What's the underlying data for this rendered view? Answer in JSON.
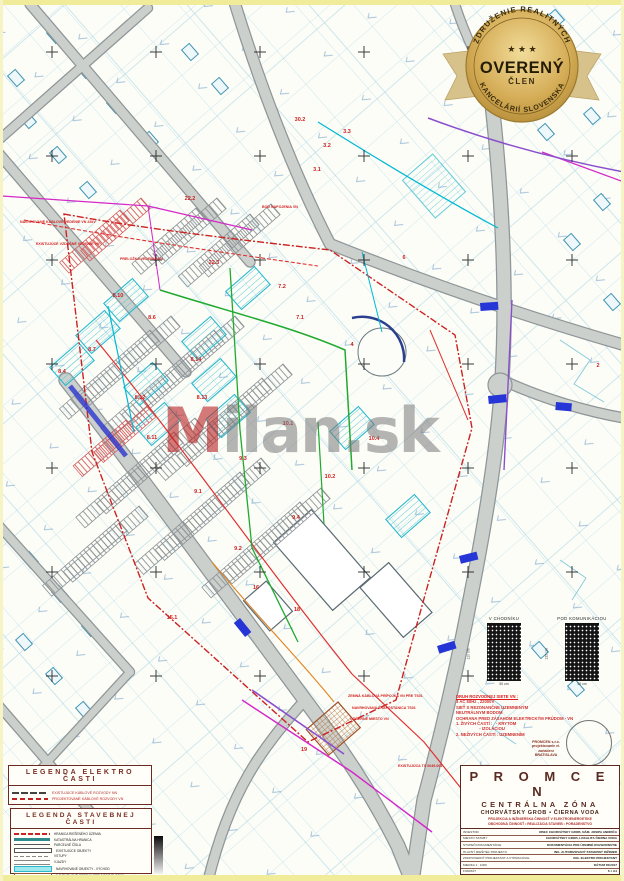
{
  "badge": {
    "arc_top": "ZDRUŽENIE REALITNÝCH",
    "arc_bottom": "KANCELÁRIÍ SLOVENSKA",
    "stars": "★ ★ ★",
    "main": "OVERENÝ",
    "sub": "ČLEN",
    "gold": "#d4ac56",
    "text_color": "#3a2c0c"
  },
  "watermark": {
    "first": "M",
    "rest": "ilan.sk"
  },
  "map": {
    "parcel_labels": [
      {
        "t": "30.2",
        "x": 300,
        "y": 120
      },
      {
        "t": "3.3",
        "x": 347,
        "y": 132
      },
      {
        "t": "3.2",
        "x": 327,
        "y": 146
      },
      {
        "t": "3.1",
        "x": 317,
        "y": 170
      },
      {
        "t": "22.2",
        "x": 190,
        "y": 199
      },
      {
        "t": "22.3",
        "x": 214,
        "y": 263
      },
      {
        "t": "7.2",
        "x": 282,
        "y": 287
      },
      {
        "t": "7.1",
        "x": 300,
        "y": 318
      },
      {
        "t": "8.10",
        "x": 118,
        "y": 296
      },
      {
        "t": "8.6",
        "x": 152,
        "y": 318
      },
      {
        "t": "8.7",
        "x": 92,
        "y": 350
      },
      {
        "t": "8.4",
        "x": 62,
        "y": 372
      },
      {
        "t": "8.14",
        "x": 196,
        "y": 360
      },
      {
        "t": "8.13",
        "x": 202,
        "y": 398
      },
      {
        "t": "8.12",
        "x": 140,
        "y": 398
      },
      {
        "t": "8.11",
        "x": 152,
        "y": 438
      },
      {
        "t": "10.1",
        "x": 288,
        "y": 424
      },
      {
        "t": "10.4",
        "x": 374,
        "y": 439
      },
      {
        "t": "10.2",
        "x": 330,
        "y": 477
      },
      {
        "t": "9.3",
        "x": 243,
        "y": 459
      },
      {
        "t": "9.1",
        "x": 198,
        "y": 492
      },
      {
        "t": "9.4",
        "x": 296,
        "y": 518
      },
      {
        "t": "9.2",
        "x": 238,
        "y": 549
      },
      {
        "t": "16",
        "x": 256,
        "y": 588
      },
      {
        "t": "18",
        "x": 297,
        "y": 610
      },
      {
        "t": "15.1",
        "x": 172,
        "y": 618
      },
      {
        "t": "19",
        "x": 304,
        "y": 750
      },
      {
        "t": "2",
        "x": 598,
        "y": 366
      },
      {
        "t": "4",
        "x": 352,
        "y": 345
      },
      {
        "t": "6",
        "x": 404,
        "y": 258
      }
    ],
    "callouts": [
      {
        "t": "NAVRHOVANÉ KÁBLOVÉ VEDENIE VN 22kV",
        "x": 20,
        "y": 220
      },
      {
        "t": "EXISTUJÚCE VZDUŠNÉ VEDENIE VN",
        "x": 36,
        "y": 242
      },
      {
        "t": "PRELOŽKA VEDENIA NN",
        "x": 120,
        "y": 257
      },
      {
        "t": "BOD NAPOJENIA VN",
        "x": 262,
        "y": 205
      },
      {
        "t": "ZEMNÁ KÁBLOVÁ PRÍPOJKA VN PRE TS01",
        "x": 348,
        "y": 694
      },
      {
        "t": "NAVRHOVANÁ TRAFOSTANICA TS01",
        "x": 352,
        "y": 706
      },
      {
        "t": "ODBERNÉ MIESTO VN",
        "x": 350,
        "y": 717
      },
      {
        "t": "EXISTUJÚCA TS 0049-001",
        "x": 398,
        "y": 764
      }
    ]
  },
  "details": {
    "left": {
      "label": "V CHODNÍKU",
      "h": "110 cm",
      "w": "50 cm"
    },
    "right": {
      "label": "POD KOMUNIKÁCIOU",
      "h": "125 cm",
      "w": "50 cm"
    }
  },
  "specs": {
    "lines": [
      "DRUH ROZVODNEJ SIETE VN :",
      "3 AC 50Hz , 22000V",
      "SIEŤ S REZONANČNE UZEMNENÝM",
      "NEUTRÁLNYM BODOM",
      "OCHRANA PRED ZÁSAHOM ELEKTRICKÝM PRÚDOM - VN",
      "1. ŽIVÝCH ČASTÍ :   - KRYTOM",
      "                    - IZOLÁCIOU",
      "2. NEŽIVÝCH ČASTÍ : UZEMNENÍM"
    ]
  },
  "stamp": {
    "logo_lines": [
      "PROMCEN s.r.o.",
      "projektovanie el. zariadení",
      "BRATISLAVA"
    ]
  },
  "legends": {
    "elektro": {
      "title": "LEGENDA ELEKTRO ČASTI",
      "rows": [
        {
          "swatch": "sw-exist-nn",
          "label": "EXISTUJÚCE KÁBLOVÉ ROZVODY NN",
          "color": "#b03030"
        },
        {
          "swatch": "sw-proj-nn",
          "label": "PROJEKTOVANÉ KÁBLOVÉ ROZVODY VN",
          "color": "#c02020"
        }
      ]
    },
    "stavebna": {
      "title": "LEGENDA STAVEBNEJ ČASTI",
      "rows": [
        {
          "swatch": "sw-boundary",
          "label": "HRANICA RIEŠENÉHO ÚZEMIA"
        },
        {
          "swatch": "sw-kataster",
          "label": "KATASTRÁLNA HRANICA"
        },
        {
          "swatch": "sw-parcel",
          "label": "PARCELNÉ ČÍSLA"
        },
        {
          "swatch": "sw-exist",
          "label": "EXISTUJÚCE OBJEKTY"
        },
        {
          "swatch": "sw-vstupy",
          "label": "VSTUPY"
        },
        {
          "swatch": "sw-vjazdy",
          "label": "VJAZDY"
        },
        {
          "swatch": "sw-navrh-obj",
          "label": "NAVRHOVANÉ OBJEKTY - VÝCHOD"
        },
        {
          "swatch": "sw-cesty",
          "label": "NAVRHOVANÉ CESTY A SPEVNENÉ PLOCHY"
        },
        {
          "swatch": "sw-park",
          "label": "NAVRHOVANÉ ODSTAVNÉ A PARKOVACIE PLOCHY"
        }
      ]
    }
  },
  "title_block": {
    "company": "P R O M C E N",
    "zone": "CENTRÁLNA ZÓNA",
    "place": "CHORVÁTSKY GROB • ČIERNA VODA",
    "red1": "PROJEKCIA A INŽINIERSKA ČINNOSŤ V ELEKTROENERGETIKE",
    "red2": "OBCHODNÁ ČINNOSŤ • REALIZÁCIA STAVIEB • PORADENSTVO",
    "rows": [
      {
        "l": "INVESTOR",
        "r": "OBEC CHORVÁTSKY GROB, NÁM. JOSIPA ANDRIČA"
      },
      {
        "l": "MIESTO STAVBY",
        "r": "CHORVÁTSKY GROB, LOKALITA ČIERNA VODA"
      },
      {
        "l": "STUPEŇ DOKUMENTÁCIE",
        "r": "DOKUMENTÁCIA PRE ÚZEMNÉ ROZHODNUTIE"
      },
      {
        "l": "HLAVNÝ RIEŠITEĽ PROJEKTU",
        "r": "ING. AUTORIZOVANÝ STAVEBNÝ INŽINIER"
      },
      {
        "l": "ZODPOVEDNÝ PROJEKTANT A VYPRACOVAL",
        "r": "ING. ELEKTRO PROJEKTANT"
      },
      {
        "l": "MIERKA  1 : 1000",
        "r": "DÁTUM  05/2017"
      },
      {
        "l": "FORMÁT",
        "r": "6 × A4"
      }
    ],
    "bottom": {
      "objekt_header": "OBJEKT",
      "objekt_code": "SO 04.3",
      "objekt_name": "ZEMNÁ KÁBLOVÁ PRÍPOJKA VN PRE TS01",
      "cislo_header": "ČÍSLO VÝKRESU",
      "cislo": "02",
      "nazov_header": "NÁZOV VÝKRESU",
      "nazov": "KOORDINAČNÁ SITUÁCIA"
    }
  }
}
